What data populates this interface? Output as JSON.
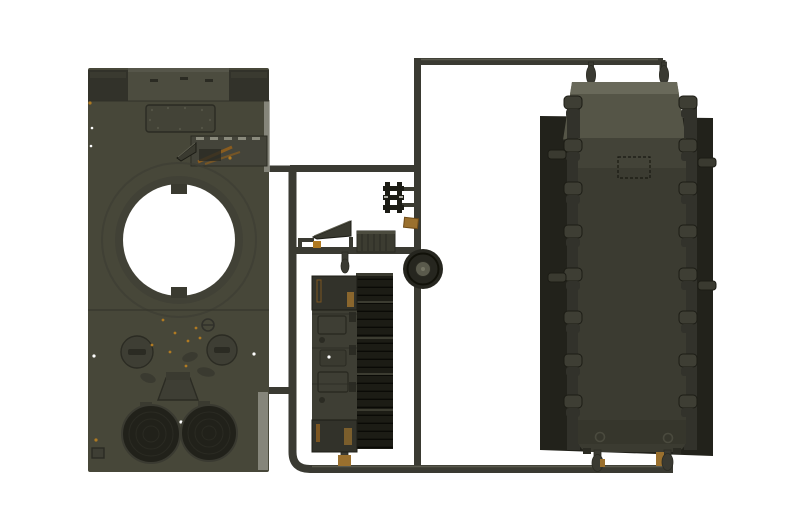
{
  "scene": {
    "type": "product-photograph",
    "subject": "Injection-molded plastic model kit sprue with olive-drab tank parts on a white background",
    "background_color": "#ffffff"
  },
  "colors": {
    "white": "#ffffff",
    "runner": "#3a3a32",
    "runner_hi": "#6a6a5e",
    "hull_olive": "#474739",
    "hull_band": "#4c4c3f",
    "hull_collar": "#414136",
    "block_dark": "#32322a",
    "panel_recess": "#434337",
    "tool_panel": "#44443a",
    "detail_dark": "#2b2b23",
    "detail_mid": "#3a3a30",
    "near_black": "#1c1c15",
    "louvre_light": "#3c3c31",
    "backing_panel": "#22221b",
    "tub_olive": "#3b3b31",
    "tub_light": "#434338",
    "trapezoid_face": "#555547",
    "trapezoid_top": "#69695a",
    "rail_dark": "#32322b",
    "arm_olive": "#3e3e34",
    "grille_dark": "#21211a",
    "grille_rim": "#3a3a31",
    "tan": "#9a702e",
    "orange": "#b07a22",
    "rust": "#8a5c1e",
    "hub": "#5a5a4c",
    "wheel_dark": "#26261f",
    "edge_light": "#9a9a90"
  },
  "parts": [
    {
      "id": "upper-hull-part",
      "label": "Tank upper hull with circular turret-ring opening, twin round crew hatches and two circular engine grilles"
    },
    {
      "id": "engine-deck-part",
      "label": "Long louvered engine-deck / radiator panel"
    },
    {
      "id": "wedge-part",
      "label": "Small wedge-shaped part on bracket frame"
    },
    {
      "id": "slat-panel-part",
      "label": "Small slatted rectangular part"
    },
    {
      "id": "h-bracket-part",
      "label": "Small black H-shaped bracket pair"
    },
    {
      "id": "tan-clip-part",
      "label": "Small tan clip part on runner"
    },
    {
      "id": "road-wheel-part",
      "label": "Single road wheel with hub"
    },
    {
      "id": "lower-hull-part",
      "label": "Lower hull tub with suspension-arm mounts over a dark flat backing plate"
    },
    {
      "id": "sprue-runner-frame",
      "label": "Dark plastic runner frame connecting all parts"
    }
  ]
}
